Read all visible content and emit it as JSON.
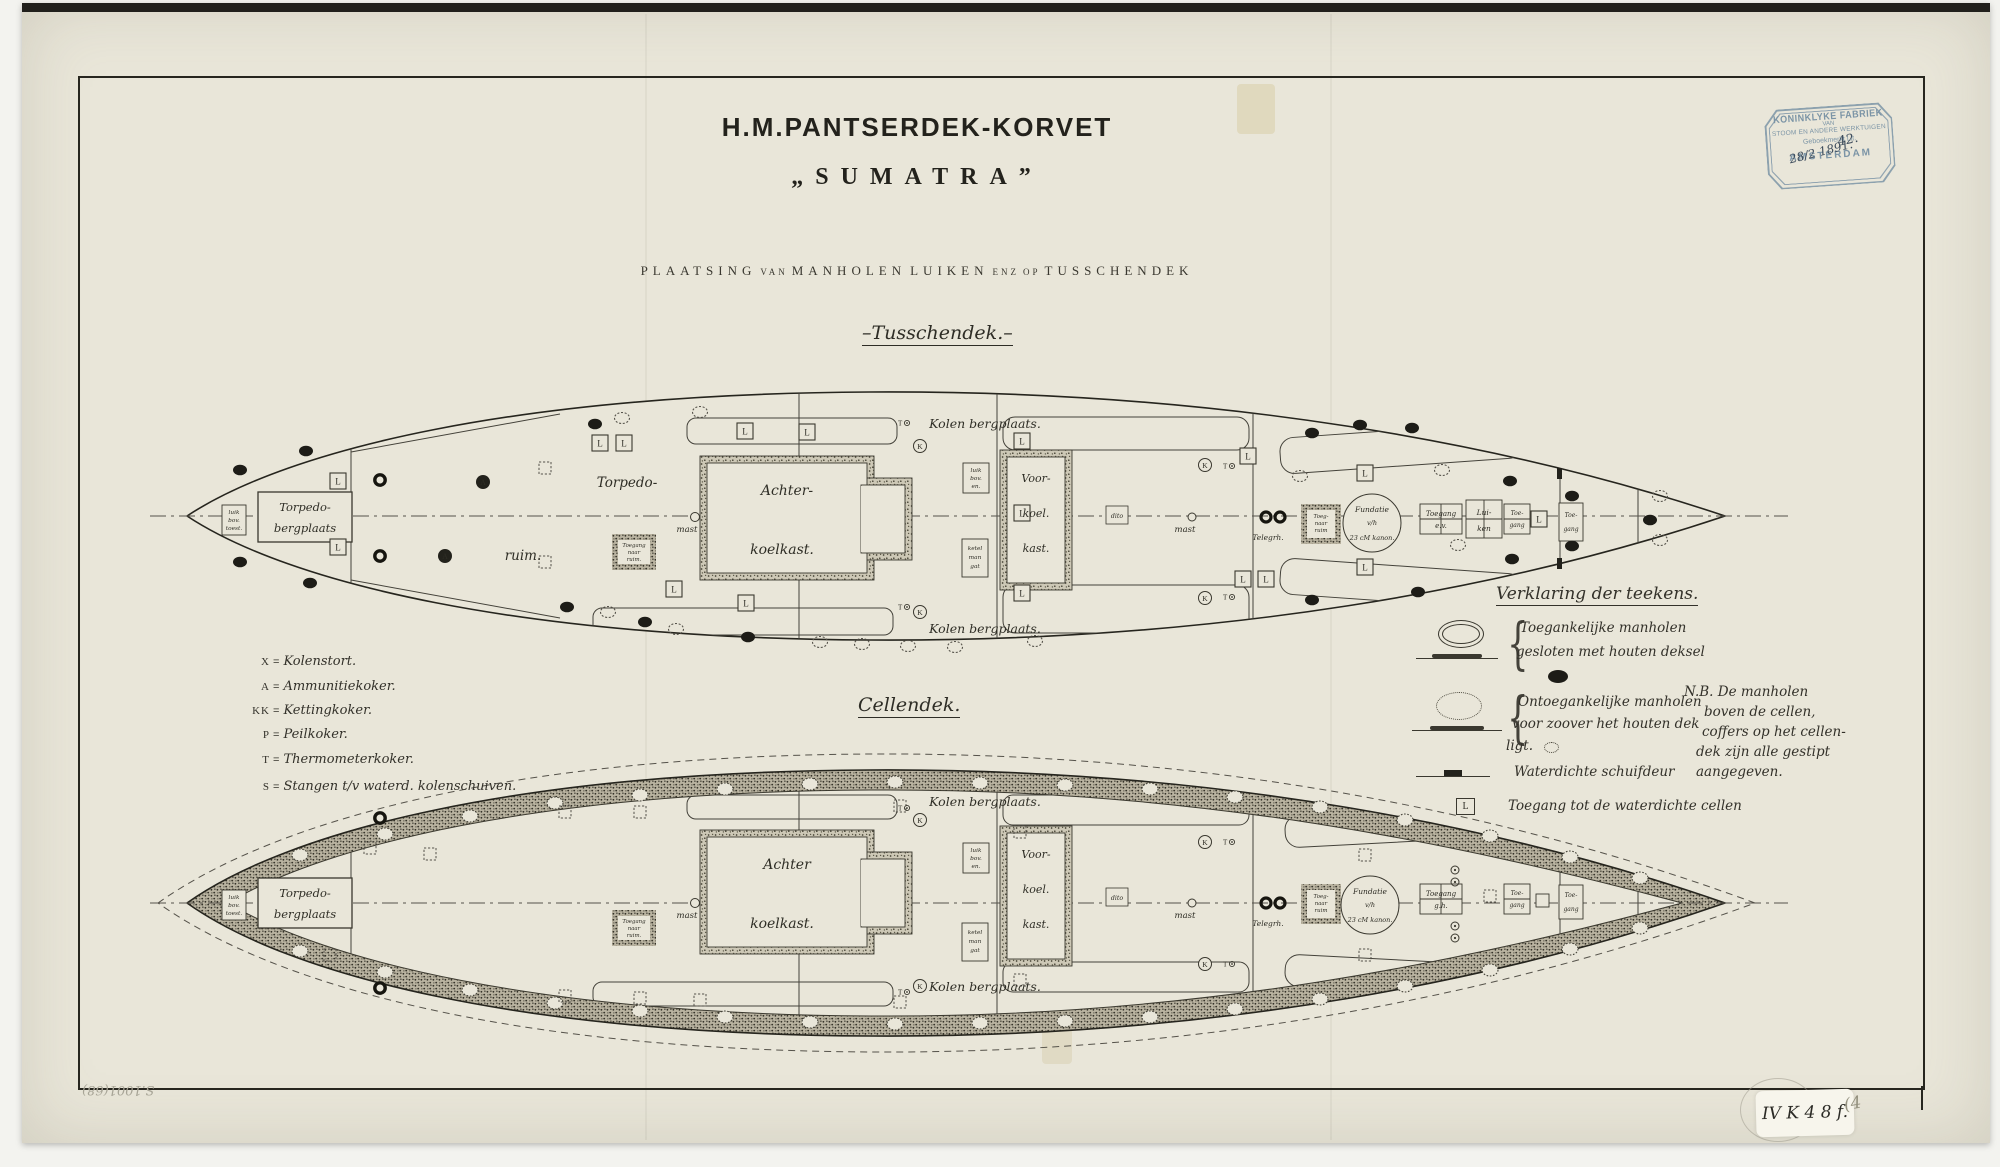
{
  "page": {
    "scan_bg": "#f3f3ef",
    "paper": "#e9e6d9",
    "ink": "#28271f",
    "stamp_blue": "#7b94a6"
  },
  "header": {
    "title_line1": "H.M.PANTSERDEK-KORVET",
    "title_line2": "„SUMATRA”",
    "subtitle_1": "PLAATSING",
    "subtitle_2": "VAN",
    "subtitle_3": "MANHOLEN",
    "subtitle_4": "LUIKEN",
    "subtitle_5": "ENZ",
    "subtitle_6": "OP",
    "subtitle_7": "TUSSCHENDEK"
  },
  "stamp": {
    "line1": "KONINKLYKE FABRIEK",
    "line2": "VAN",
    "line3": "STOOM EN ANDERE WERKTUIGEN",
    "line4": "Geboekmerkt Lit.",
    "hand_number": "42.",
    "hand_date": "28/2 1891.",
    "line5": "AMSTERDAM"
  },
  "plans": {
    "tusschendek": {
      "caption": "–Tusschendek.–",
      "labels": {
        "stern_box_l1": "luik",
        "stern_box_l2": "bov.",
        "stern_box_l3": "toest.",
        "torpedo_l1": "Torpedo-",
        "torpedo_l2": "bergplaats",
        "hold_l1": "Torpedo-",
        "hold_l2": "ruim.",
        "achter_l1": "Achter-",
        "achter_l2": "koelkast.",
        "voor_l1": "Voor-",
        "voor_l2": "koel.",
        "voor_l3": "kast.",
        "luik_l1": "luik",
        "luik_l2": "bov.",
        "luik_l3": "en.",
        "ketel_l1": "ketel",
        "ketel_l2": "man",
        "ketel_l3": "gat",
        "kolen_top": "Kolen bergplaats.",
        "kolen_bottom": "Kolen bergplaats.",
        "mast1": "mast",
        "mast2": "mast",
        "dito": "dito",
        "toegang_ruim_l1": "Toegang",
        "toegang_ruim_l2": "naar",
        "toegang_ruim_l3": "ruim.",
        "toegang_ruim2_l1": "Toeg-",
        "toegang_ruim2_l2": "naar",
        "toegang_ruim2_l3": "ruim",
        "telegraph": "Telegrh.",
        "fundatie_l1": "Fundatie",
        "fundatie_l2": "v/h",
        "fundatie_l3": "23 cM kanon.",
        "toegang_ev_l1": "Toegang",
        "toegang_ev_l2": "e.v.",
        "luiken_l1": "Lui-",
        "luiken_l2": "ken",
        "toegang2_l1": "Toe-",
        "toegang2_l2": "gang",
        "toegang3_l1": "Toe-",
        "toegang3_l2": "gang"
      }
    },
    "cellendek": {
      "caption": "Cellendek.",
      "labels": {
        "stern_box_l1": "luik",
        "stern_box_l2": "bov.",
        "stern_box_l3": "toest.",
        "torpedo_l1": "Torpedo-",
        "torpedo_l2": "bergplaats",
        "achter_l1": "Achter",
        "achter_l2": "koelkast.",
        "voor_l1": "Voor-",
        "voor_l2": "koel.",
        "voor_l3": "kast.",
        "luik_l1": "luik",
        "luik_l2": "bov.",
        "luik_l3": "en.",
        "ketel_l1": "ketel",
        "ketel_l2": "man",
        "ketel_l3": "gat",
        "kolen_top": "Kolen bergplaats.",
        "kolen_bottom": "Kolen bergplaats.",
        "mast1": "mast",
        "mast2": "mast",
        "dito": "dito",
        "toegang_ruim_l1": "Toegang",
        "toegang_ruim_l2": "naar",
        "toegang_ruim_l3": "ruim.",
        "toegang_ruim2_l1": "Toeg-",
        "toegang_ruim2_l2": "naar",
        "toegang_ruim2_l3": "ruim",
        "telegraph": "Telegrh.",
        "fundatie_l1": "Fundatie",
        "fundatie_l2": "v/h",
        "fundatie_l3": "23 cM kanon.",
        "toegang_ev_l1": "Toegang",
        "toegang_ev_l2": "g.h.",
        "toegang2_l1": "Toe-",
        "toegang2_l2": "gang",
        "toegang3_l1": "Toe-",
        "toegang3_l2": "gang"
      }
    }
  },
  "legend_left": {
    "eq": "=",
    "items": [
      {
        "sym": "X",
        "text": "Kolenstort."
      },
      {
        "sym": "A",
        "text": "Ammunitiekoker."
      },
      {
        "sym": "KK",
        "text": "Kettingkoker."
      },
      {
        "sym": "P",
        "text": "Peilkoker."
      },
      {
        "sym": "T",
        "text": "Thermometerkoker."
      },
      {
        "sym": "S",
        "text": "Stangen t/v waterd. kolenschuiven."
      }
    ]
  },
  "legend_right": {
    "heading": "Verklaring der teekens.",
    "brace": "{",
    "item1_l1": "Toegankelijke manholen",
    "item1_l2": "gesloten met houten deksel",
    "item2_l1": "Ontoegankelijke manholen",
    "item2_l2": "voor zoover het houten dek",
    "item2_l3": "ligt.",
    "item3": "Waterdichte schuifdeur",
    "item4": "Toegang tot de waterdichte cellen",
    "nb_l1": "N.B. De manholen",
    "nb_l2": "boven de cellen,",
    "nb_l3": "coffers op het cellen-",
    "nb_l4": "dek zijn alle gestipt",
    "nb_l5": "aangegeven."
  },
  "symbols": {
    "l": "L",
    "k": "K",
    "t": "T",
    "a": "A"
  },
  "annotations": {
    "sticker": "IV K 4 8 f.",
    "pencil_left": "S.1001(68)",
    "pencil_right": "(4"
  }
}
